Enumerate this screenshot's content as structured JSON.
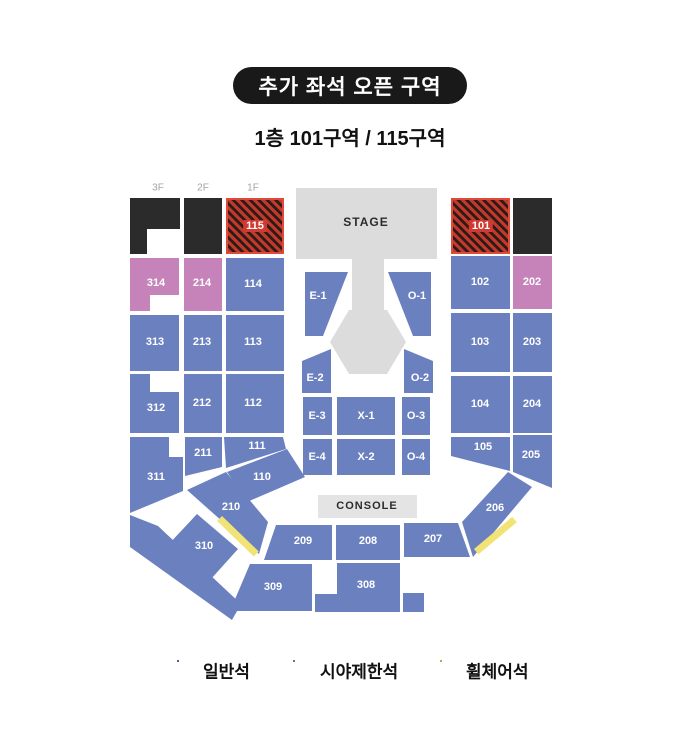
{
  "title": {
    "badge": "추가 좌석 오픈 구역",
    "subtitle": "1층 101구역 / 115구역"
  },
  "stage_label": "STAGE",
  "console_label": "CONSOLE",
  "floors": [
    {
      "label": "3F"
    },
    {
      "label": "2F"
    },
    {
      "label": "1F"
    }
  ],
  "colors": {
    "general": "#6b80bf",
    "restricted": "#c583ba",
    "wheelchair": "#f2e376",
    "closed": "#2b2b2b",
    "open_stripe": "#bf3a2d",
    "open_stripe_dark": "#301a15",
    "open_border": "#de4a3c",
    "open_label_bg": "#cf3a31",
    "stage": "#dcdcdd",
    "console": "#e4e4e4"
  },
  "legend": [
    {
      "label": "일반석",
      "type": "general"
    },
    {
      "label": "시야제한석",
      "type": "restricted"
    },
    {
      "label": "휠체어석",
      "type": "wheelchair"
    }
  ],
  "sections": [
    {
      "id": "115",
      "label": "115",
      "type": "open"
    },
    {
      "id": "101",
      "label": "101",
      "type": "open"
    },
    {
      "id": "314",
      "label": "314",
      "type": "restricted"
    },
    {
      "id": "214",
      "label": "214",
      "type": "restricted"
    },
    {
      "id": "114",
      "label": "114",
      "type": "general"
    },
    {
      "id": "102",
      "label": "102",
      "type": "general"
    },
    {
      "id": "202",
      "label": "202",
      "type": "restricted"
    },
    {
      "id": "313",
      "label": "313",
      "type": "general"
    },
    {
      "id": "213",
      "label": "213",
      "type": "general"
    },
    {
      "id": "113",
      "label": "113",
      "type": "general"
    },
    {
      "id": "103",
      "label": "103",
      "type": "general"
    },
    {
      "id": "203",
      "label": "203",
      "type": "general"
    },
    {
      "id": "312",
      "label": "312",
      "type": "general"
    },
    {
      "id": "212",
      "label": "212",
      "type": "general"
    },
    {
      "id": "112",
      "label": "112",
      "type": "general"
    },
    {
      "id": "104",
      "label": "104",
      "type": "general"
    },
    {
      "id": "204",
      "label": "204",
      "type": "general"
    },
    {
      "id": "311",
      "label": "311",
      "type": "general"
    },
    {
      "id": "211",
      "label": "211",
      "type": "general"
    },
    {
      "id": "111",
      "label": "111",
      "type": "general"
    },
    {
      "id": "105",
      "label": "105",
      "type": "general"
    },
    {
      "id": "205",
      "label": "205",
      "type": "general"
    },
    {
      "id": "110",
      "label": "110",
      "type": "general"
    },
    {
      "id": "210",
      "label": "210",
      "type": "general"
    },
    {
      "id": "310",
      "label": "310",
      "type": "general"
    },
    {
      "id": "206",
      "label": "206",
      "type": "general"
    },
    {
      "id": "209",
      "label": "209",
      "type": "general"
    },
    {
      "id": "208",
      "label": "208",
      "type": "general"
    },
    {
      "id": "207",
      "label": "207",
      "type": "general"
    },
    {
      "id": "309",
      "label": "309",
      "type": "general"
    },
    {
      "id": "308",
      "label": "308",
      "type": "general"
    },
    {
      "id": "E-1",
      "label": "E-1",
      "type": "general"
    },
    {
      "id": "O-1",
      "label": "O-1",
      "type": "general"
    },
    {
      "id": "E-2",
      "label": "E-2",
      "type": "general"
    },
    {
      "id": "O-2",
      "label": "O-2",
      "type": "general"
    },
    {
      "id": "E-3",
      "label": "E-3",
      "type": "general"
    },
    {
      "id": "X-1",
      "label": "X-1",
      "type": "general"
    },
    {
      "id": "O-3",
      "label": "O-3",
      "type": "general"
    },
    {
      "id": "E-4",
      "label": "E-4",
      "type": "general"
    },
    {
      "id": "X-2",
      "label": "X-2",
      "type": "general"
    },
    {
      "id": "O-4",
      "label": "O-4",
      "type": "general"
    }
  ]
}
